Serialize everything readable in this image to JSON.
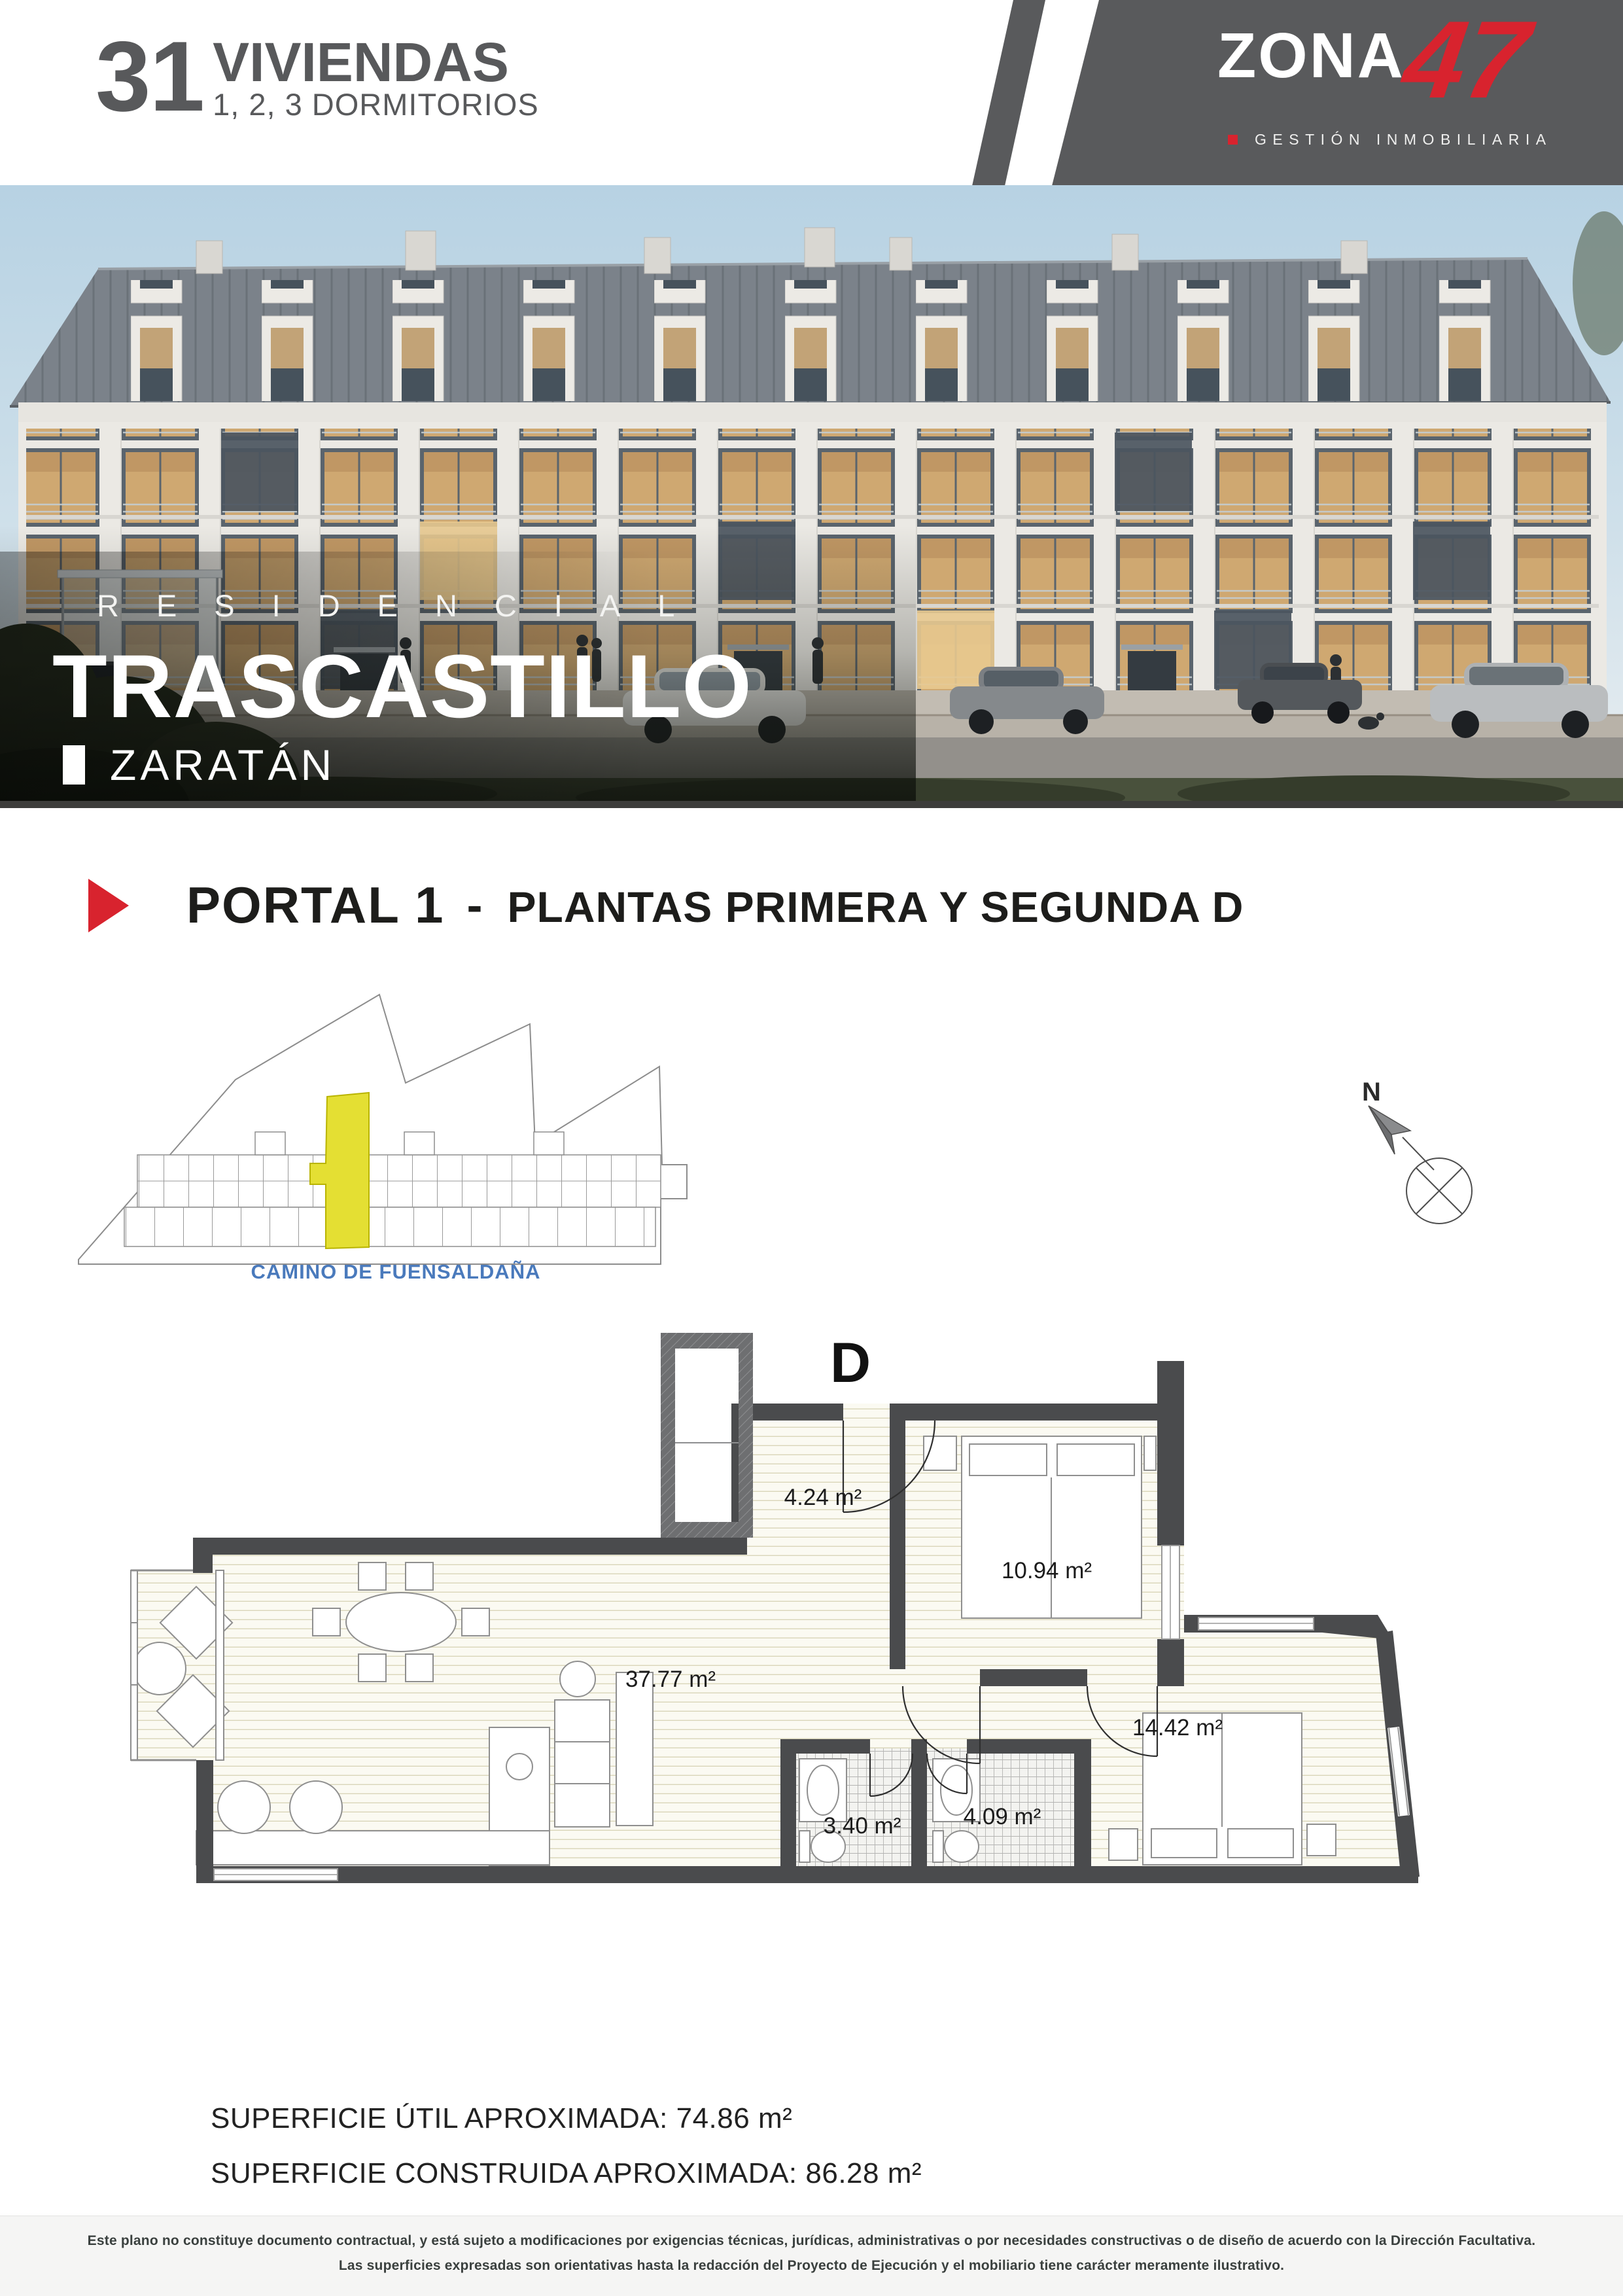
{
  "header": {
    "units_count": "31",
    "units_label": "VIVIENDAS",
    "units_subtitle": "1, 2, 3 DORMITORIOS"
  },
  "brand": {
    "name_text": "ZONA",
    "name_number": "47",
    "tagline": "GESTIÓN INMOBILIARIA"
  },
  "hero": {
    "kicker": "RESIDENCIAL",
    "title": "TRASCASTILLO",
    "location": "ZARATÁN"
  },
  "section_title": {
    "portal": "PORTAL 1",
    "separator": "-",
    "plantas": "PLANTAS PRIMERA Y SEGUNDA D"
  },
  "site_plan": {
    "street_label": "CAMINO DE FUENSALDAÑA"
  },
  "compass": {
    "north_label": "N"
  },
  "floor_plan": {
    "unit_letter": "D",
    "rooms": [
      {
        "name": "hall",
        "area": "4.24 m²"
      },
      {
        "name": "dormitorio-1",
        "area": "10.94 m²"
      },
      {
        "name": "salon-comedor-cocina",
        "area": "37.77 m²"
      },
      {
        "name": "dormitorio-2",
        "area": "14.42 m²"
      },
      {
        "name": "bano-1",
        "area": "3.40 m²"
      },
      {
        "name": "bano-2",
        "area": "4.09 m²"
      }
    ]
  },
  "summary": {
    "superficie_util": "SUPERFICIE ÚTIL APROXIMADA: 74.86 m²",
    "superficie_construida": "SUPERFICIE CONSTRUIDA APROXIMADA: 86.28 m²"
  },
  "footer": {
    "line1": "Este plano no constituye documento contractual, y está sujeto a modificaciones por exigencias técnicas, jurídicas, administrativas o por necesidades constructivas o de diseño de acuerdo con la Dirección Facultativa.",
    "line2": "Las superficies expresadas son orientativas hasta la redacción del Proyecto de Ejecución y el mobiliario tiene carácter meramente ilustrativo."
  },
  "colors": {
    "accent_red": "#d8232e",
    "banner_gray": "#595a5c",
    "text_gray": "#58595b",
    "highlight_yellow": "#e4df33",
    "street_blue": "#4a7abc"
  }
}
